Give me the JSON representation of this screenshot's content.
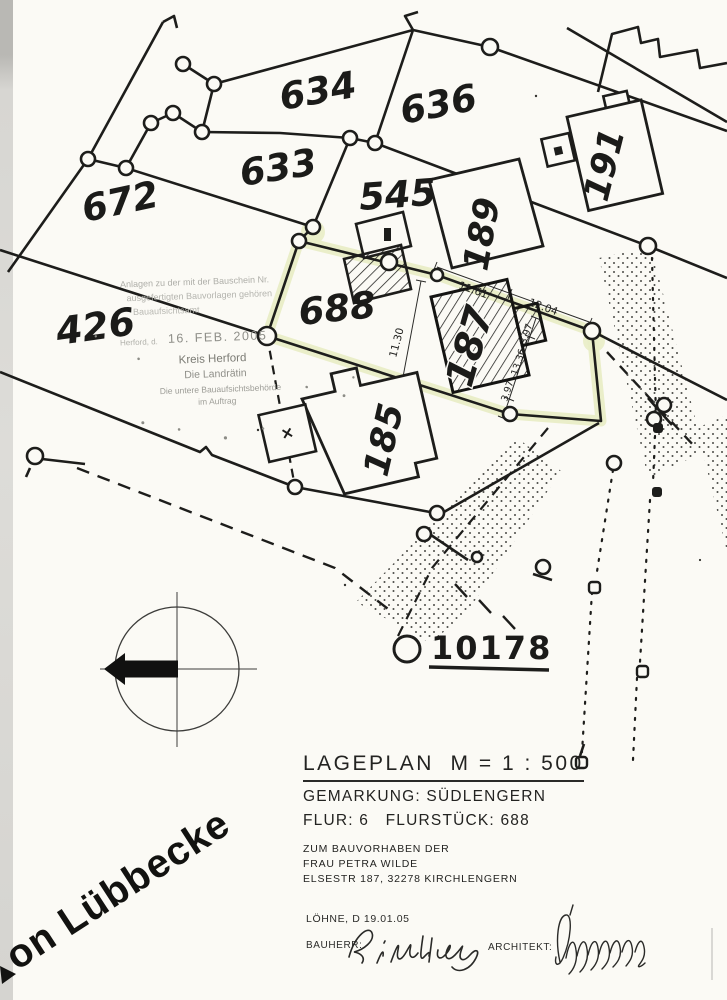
{
  "map": {
    "parcel_labels": {
      "p634": "634",
      "p636": "636",
      "p672": "672",
      "p633": "633",
      "p545": "545",
      "p426": "426",
      "p688": "688"
    },
    "building_labels": {
      "b191": "191",
      "b189": "189",
      "b187": "187",
      "b185": "185"
    },
    "survey_point_label": "10178",
    "street_name": "on Lübbecke",
    "dimensions": {
      "d1": "11.61",
      "d2": "12.04",
      "d3": "11.30",
      "d4": "3.97",
      "d5": "13.36",
      "d6": "3.97"
    },
    "highlight_color": "#e9edc6"
  },
  "stamp": {
    "line1": "Anlagen zu der mit der Bauschein Nr.",
    "line2": "ausgefertigten Bauvorlagen gehören",
    "line3": "Bauaufsichtsamt",
    "place": "Herford, d.",
    "date": "16. FEB. 2005",
    "authority": "Kreis Herford",
    "signer": "Die Landrätin",
    "office": "Die untere Bauaufsichtsbehörde",
    "by_order": "im Auftrag"
  },
  "title_block": {
    "title": "LAGEPLAN  M = 1 : 500",
    "gemarkung": "GEMARKUNG: SÜDLENGERN",
    "flur": "FLUR: 6   FLURSTÜCK: 688",
    "purpose_line1": "ZUM BAUVORHABEN DER",
    "purpose_line2": "FRAU PETRA WILDE",
    "purpose_line3": "ELSESTR 187, 32278 KIRCHLENGERN"
  },
  "footer": {
    "place_date": "LÖHNE, D 19.01.05",
    "bauherr_label": "BAUHERR:",
    "architekt_label": "ARCHITEKT:",
    "bauherr_signature": "G. Wilde"
  },
  "colors": {
    "ink": "#1d1d1b",
    "highlight": "#e9edc6",
    "stamp_gray": "#9a9a92"
  }
}
